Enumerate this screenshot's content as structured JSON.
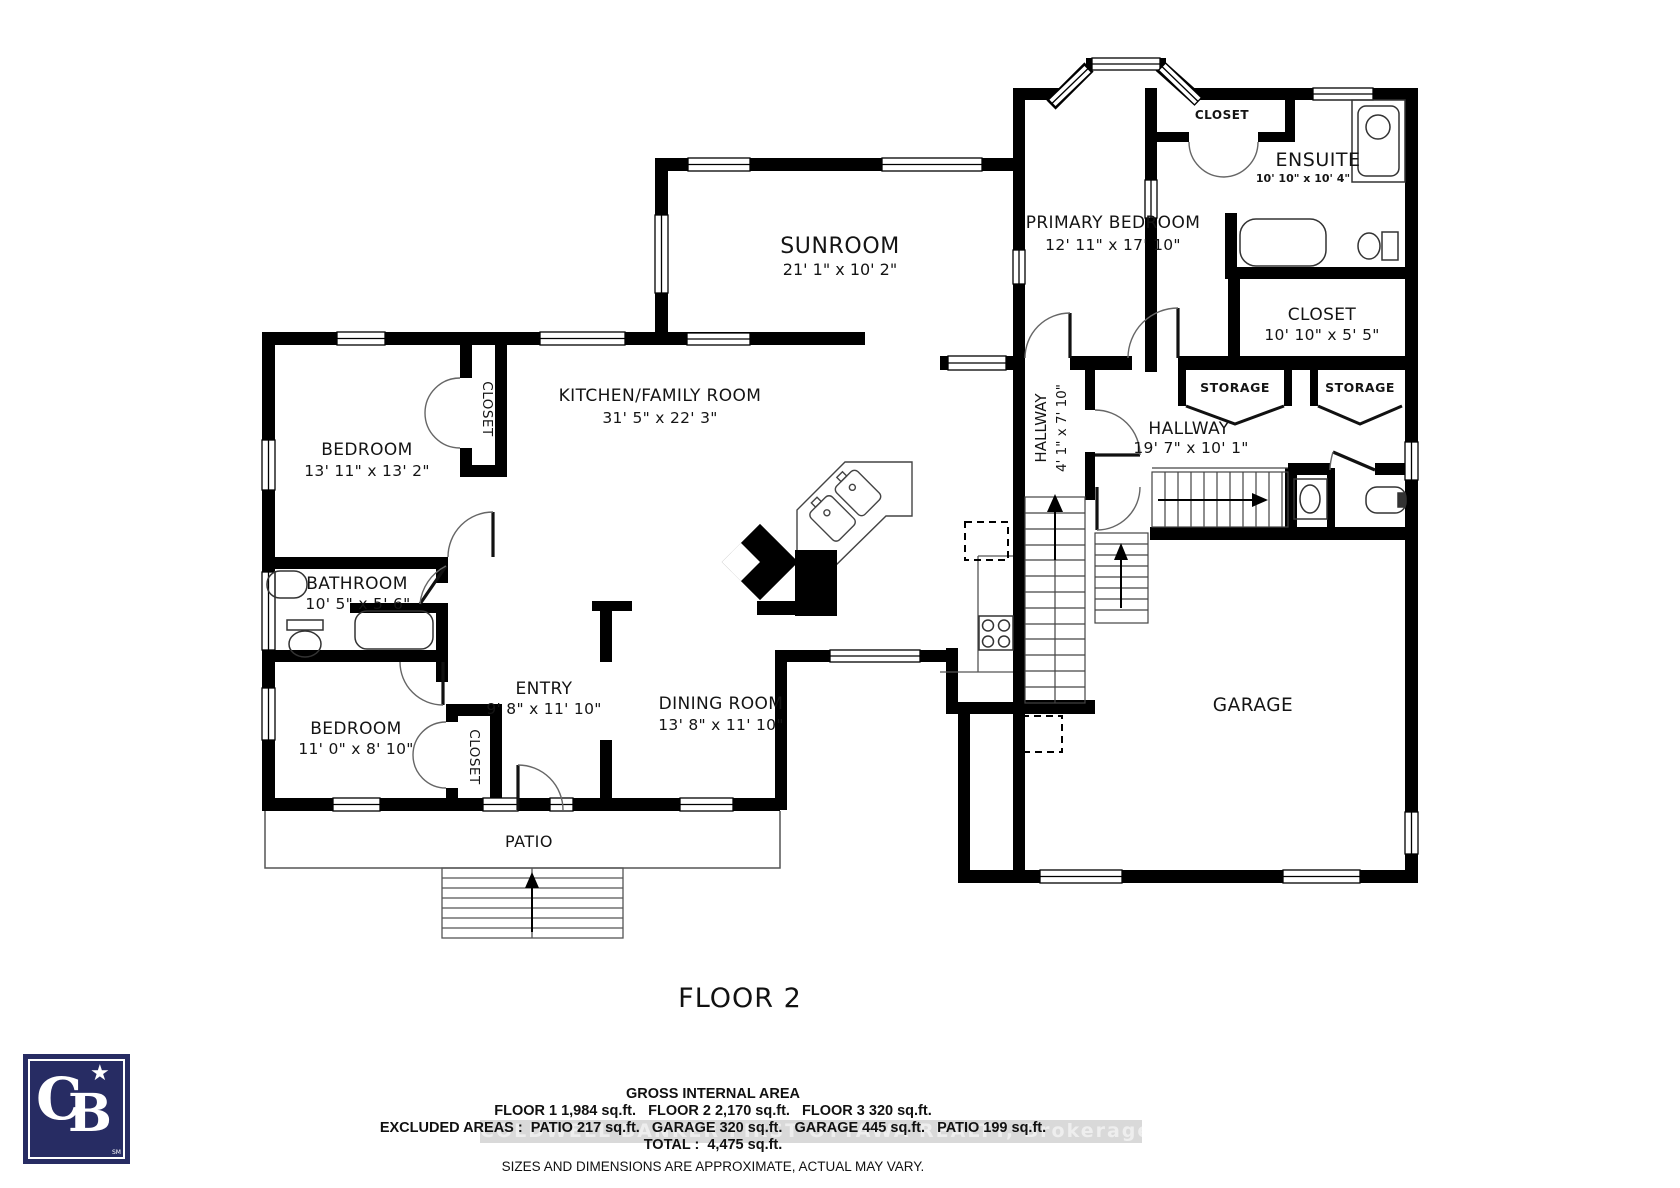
{
  "plan": {
    "floor_label": "FLOOR 2",
    "rooms": {
      "sunroom": {
        "name": "SUNROOM",
        "dims": "21' 1\" x 10' 2\""
      },
      "primary_bedroom": {
        "name": "PRIMARY BEDROOM",
        "dims": "12' 11\" x 17' 10\""
      },
      "ensuite": {
        "name": "ENSUITE",
        "dims": "10' 10\" x 10' 4\""
      },
      "ensuite_closet": {
        "name": "CLOSET"
      },
      "walkin_closet": {
        "name": "CLOSET",
        "dims": "10' 10\" x 5' 5\""
      },
      "kitchen_family_room": {
        "name": "KITCHEN/FAMILY ROOM",
        "dims": "31' 5\" x 22' 3\""
      },
      "bedroom_upper": {
        "name": "BEDROOM",
        "dims": "13' 11\" x 13' 2\""
      },
      "bedroom_upper_closet": {
        "name": "CLOSET"
      },
      "bathroom": {
        "name": "BATHROOM",
        "dims": "10' 5\" x 5' 6\""
      },
      "bedroom_lower": {
        "name": "BEDROOM",
        "dims": "11' 0\" x 8' 10\""
      },
      "bedroom_lower_closet": {
        "name": "CLOSET"
      },
      "entry": {
        "name": "ENTRY",
        "dims": "9' 8\" x 11' 10\""
      },
      "dining_room": {
        "name": "DINING ROOM",
        "dims": "13' 8\" x 11' 10\""
      },
      "hallway_small": {
        "name": "HALLWAY",
        "dims": "4' 1\" x 7' 10\""
      },
      "hallway_main": {
        "name": "HALLWAY",
        "dims": "19' 7\" x 10' 1\""
      },
      "storage_left": {
        "name": "STORAGE"
      },
      "storage_right": {
        "name": "STORAGE"
      },
      "garage": {
        "name": "GARAGE"
      },
      "patio": {
        "name": "PATIO"
      }
    }
  },
  "footer": {
    "gross_internal_area_title": "GROSS INTERNAL AREA",
    "floors_line": "FLOOR 1 1,984 sq.ft.   FLOOR 2 2,170 sq.ft.   FLOOR 3 320 sq.ft.",
    "excluded_line": "EXCLUDED AREAS :  PATIO 217 sq.ft.   GARAGE 320 sq.ft.   GARAGE 445 sq.ft.   PATIO 199 sq.ft.",
    "total_line": "TOTAL :  4,475 sq.ft.",
    "disclaimer": "SIZES AND DIMENSIONS ARE APPROXIMATE, ACTUAL MAY VARY.",
    "watermark": "COLDWELL BANKER FIRST OTTAWA REALTY, Brokerage"
  },
  "logo": {
    "monogram_c": "C",
    "monogram_b": "B",
    "star": "★",
    "trademark": "SM"
  },
  "colors": {
    "wall": "#000000",
    "logo_navy": "#272c63",
    "watermark_band": "#d9d9d9"
  }
}
